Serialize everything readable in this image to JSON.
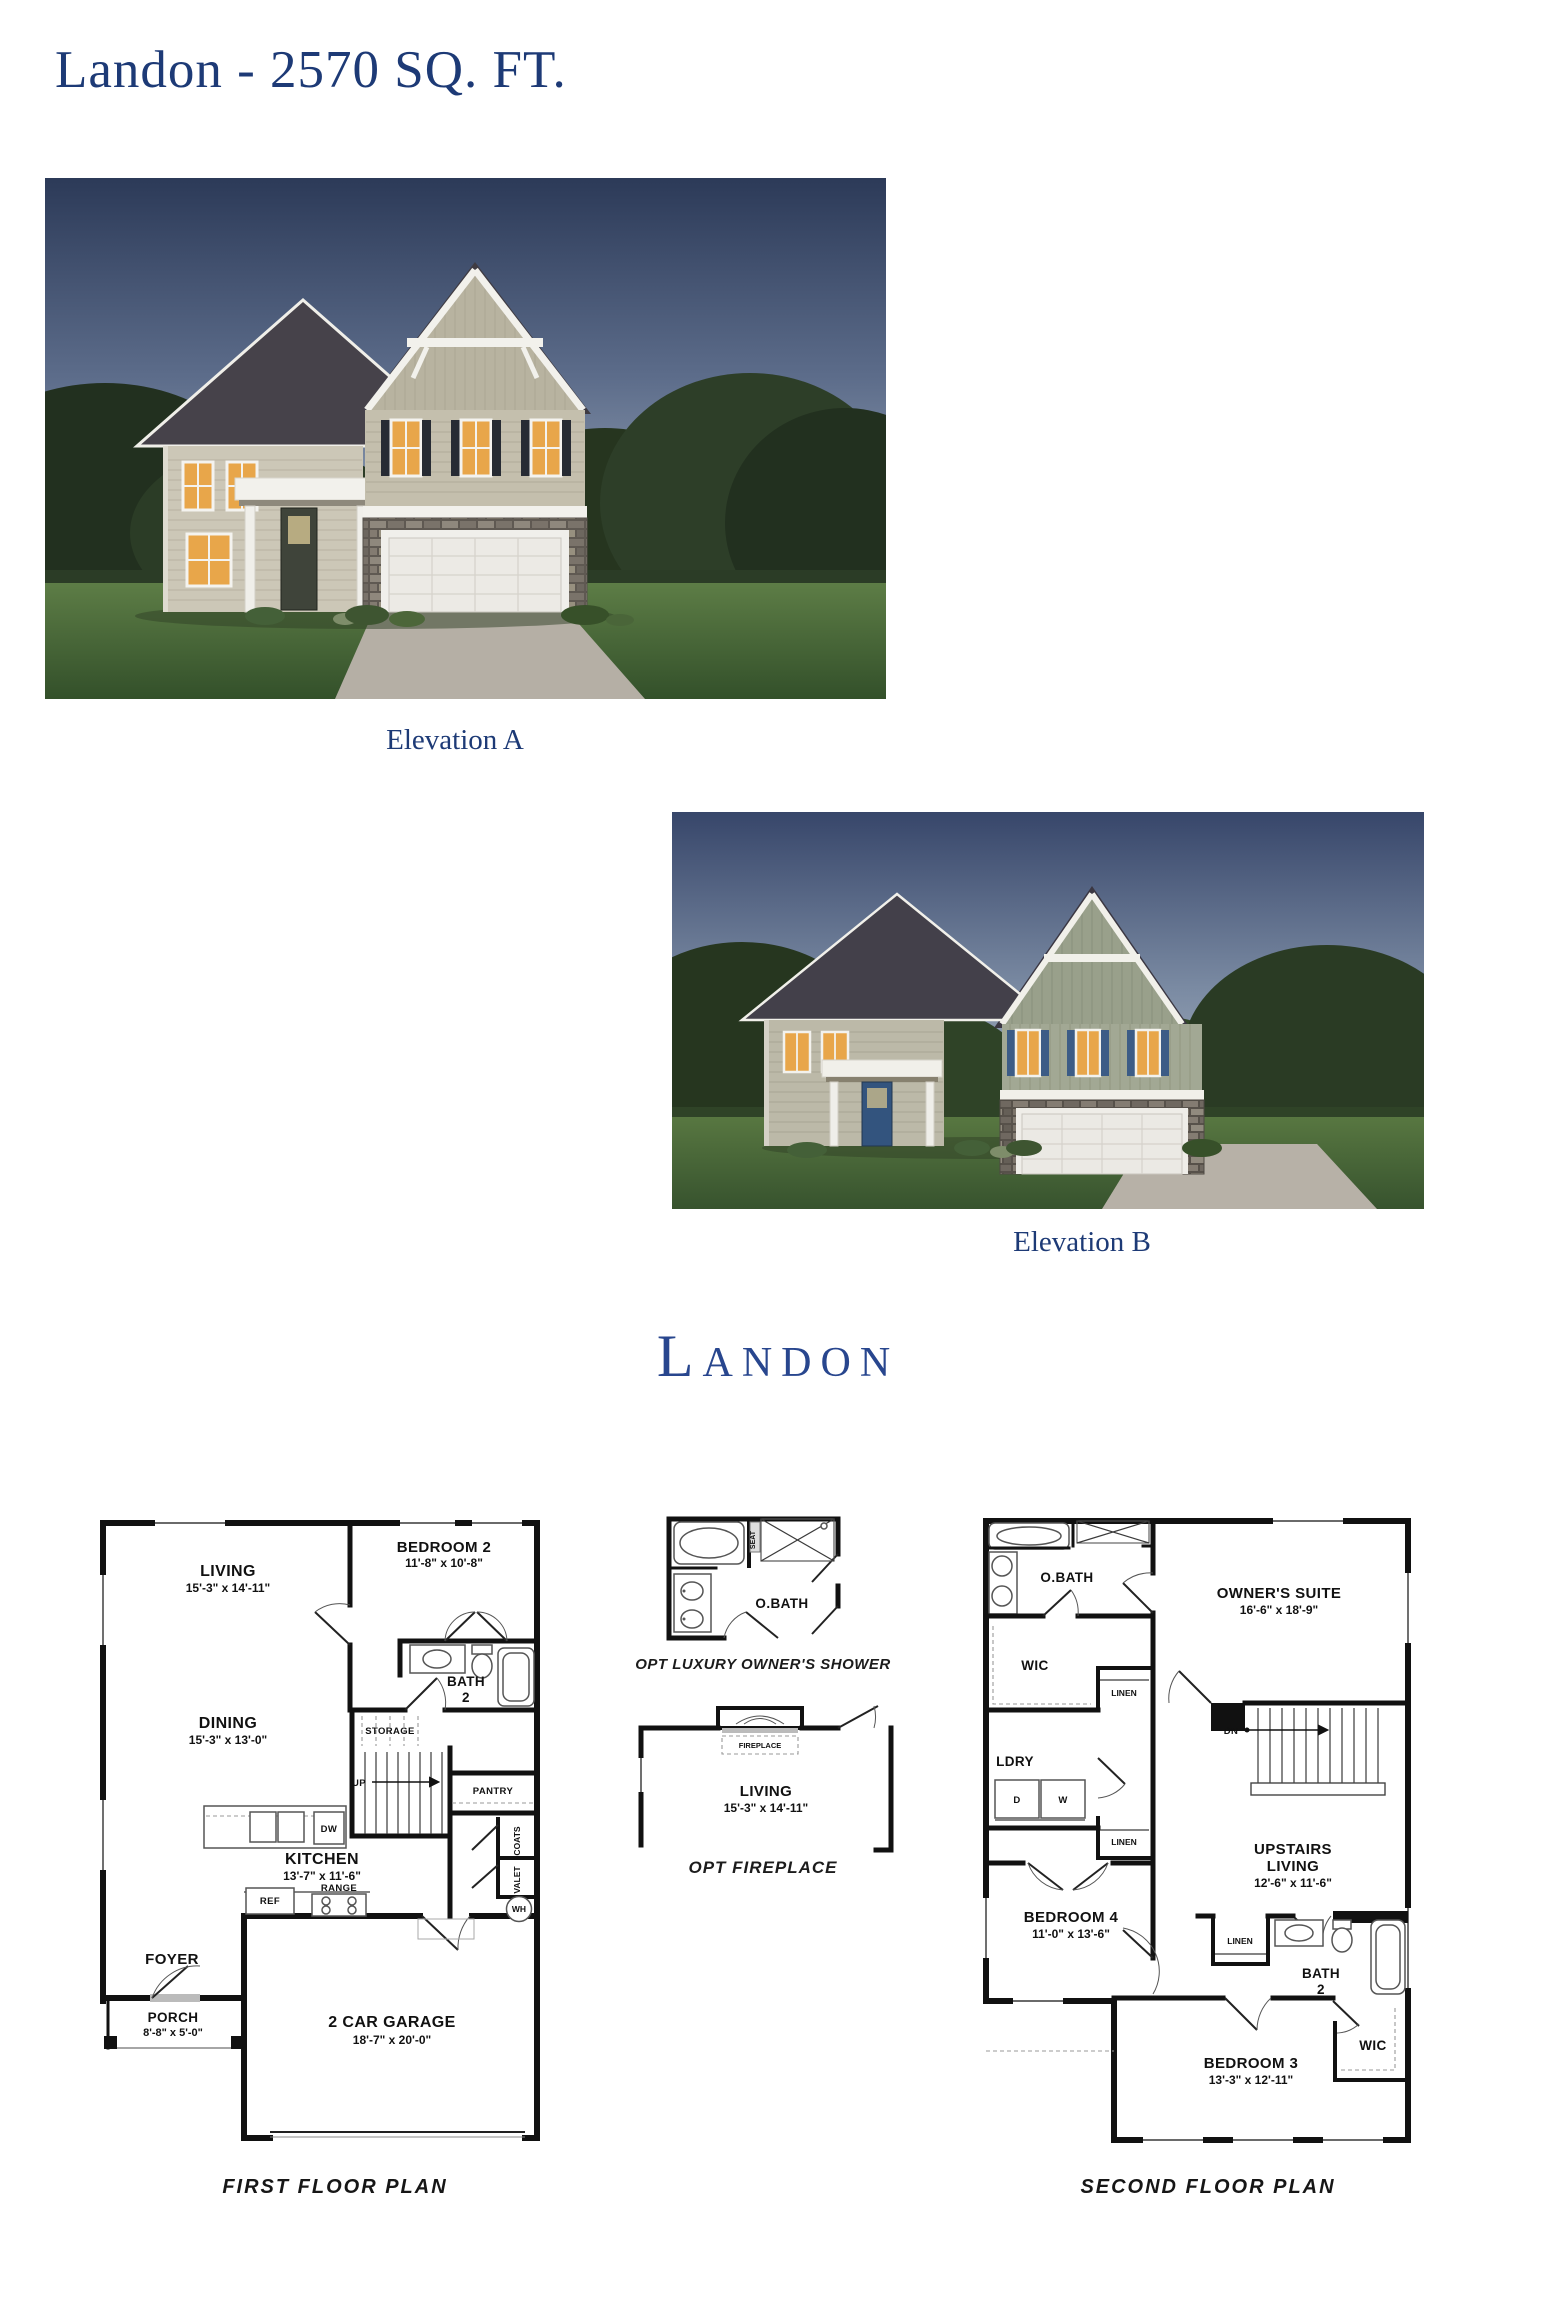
{
  "page": {
    "title": "Landon - 2570 SQ. FT.",
    "logo_text": "Landon",
    "accent_color": "#1d3a76",
    "logo_color": "#28468e"
  },
  "elevations": {
    "a_caption": "Elevation A",
    "b_caption": "Elevation B"
  },
  "first_floor": {
    "caption": "FIRST FLOOR PLAN",
    "living": {
      "name": "LIVING",
      "dims": "15'-3\" x 14'-11\""
    },
    "bedroom2": {
      "name": "BEDROOM 2",
      "dims": "11'-8\" x 10'-8\""
    },
    "bath2": {
      "name_top": "BATH",
      "name_bottom": "2"
    },
    "dining": {
      "name": "DINING",
      "dims": "15'-3\" x 13'-0\""
    },
    "kitchen": {
      "name": "KITCHEN",
      "dims": "13'-7\" x 11'-6\""
    },
    "foyer": "FOYER",
    "porch": {
      "name": "PORCH",
      "dims": "8'-8\" x 5'-0\""
    },
    "garage": {
      "name": "2 CAR GARAGE",
      "dims": "18'-7\" x 20'-0\""
    },
    "storage": "STORAGE",
    "up": "UP",
    "pantry": "PANTRY",
    "coats": "COATS",
    "valet": "VALET",
    "dw": "DW",
    "ref": "REF",
    "range": "RANGE",
    "wh": "WH"
  },
  "options": {
    "shower": {
      "room": "O.BATH",
      "seat": "SEAT",
      "caption": "OPT LUXURY OWNER'S SHOWER"
    },
    "fireplace": {
      "label": "FIREPLACE",
      "room": "LIVING",
      "dims": "15'-3\" x 14'-11\"",
      "caption": "OPT FIREPLACE"
    }
  },
  "second_floor": {
    "caption": "SECOND FLOOR PLAN",
    "obath": "O.BATH",
    "owners_suite": {
      "name": "OWNER'S SUITE",
      "dims": "16'-6\" x 18'-9\""
    },
    "wic_upper": "WIC",
    "linen_hall": "LINEN",
    "ldry": "LDRY",
    "dryer": "D",
    "washer": "W",
    "dn": "DN",
    "linen_bed4": "LINEN",
    "upstairs_living": {
      "name_top": "UPSTAIRS",
      "name_bottom": "LIVING",
      "dims": "12'-6\" x 11'-6\""
    },
    "bedroom4": {
      "name": "BEDROOM 4",
      "dims": "11'-0\" x 13'-6\""
    },
    "linen_bath": "LINEN",
    "bath2": {
      "name_top": "BATH",
      "name_bottom": "2"
    },
    "bedroom3": {
      "name": "BEDROOM 3",
      "dims": "13'-3\" x 12'-11\""
    },
    "wic_lower": "WIC"
  }
}
